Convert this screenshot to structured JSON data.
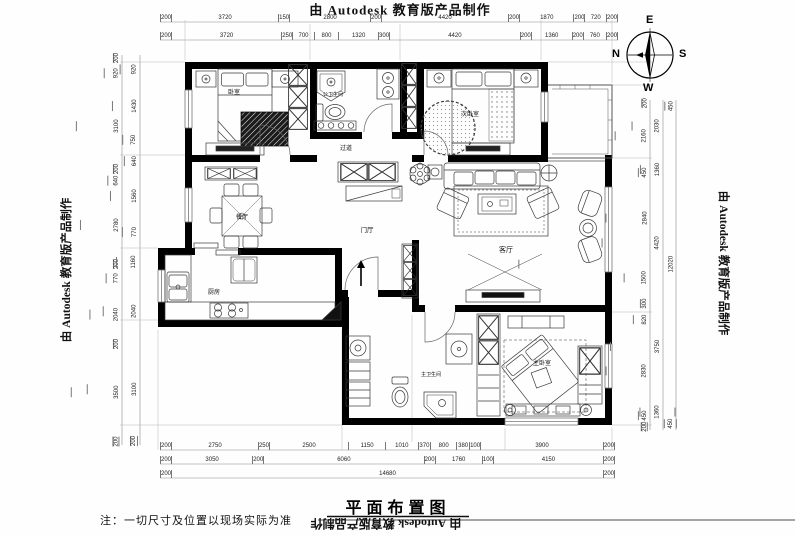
{
  "watermark": {
    "text": "由 Autodesk 教育版产品制作"
  },
  "title": {
    "text": "平面布置图"
  },
  "note": {
    "text": "注：一切尺寸及位置以现场实际为准"
  },
  "compass": {
    "e": "E",
    "n": "N",
    "s": "S",
    "w": "W"
  },
  "rooms": {
    "bedroom1": {
      "label": "卧室"
    },
    "bath1": {
      "label": "公卫生间"
    },
    "bedroom2": {
      "label": "次卧室"
    },
    "dining": {
      "label": "餐厅"
    },
    "corridor": {
      "label": "过道"
    },
    "foyer": {
      "label": "门厅"
    },
    "living": {
      "label": "客厅"
    },
    "kitchen": {
      "label": "厨房"
    },
    "bath2": {
      "label": "主卫生间"
    },
    "master": {
      "label": "主卧室"
    }
  },
  "dimensions": {
    "top_row1": [
      "200",
      "3720",
      "150",
      "2800",
      "200",
      "4420",
      "200",
      "1870",
      "200",
      "720",
      "200"
    ],
    "top_row2": [
      "200",
      "3720",
      "250",
      "700",
      "800",
      "1320",
      "300",
      "4420",
      "200",
      "1360",
      "200",
      "760",
      "200"
    ],
    "bottom_row1": [
      "200",
      "2750",
      "250",
      "2500",
      "1150",
      "1010",
      "370",
      "800",
      "380",
      "100",
      "3900",
      "200"
    ],
    "bottom_row2": [
      "200",
      "3050",
      "200",
      "6060",
      "200",
      "1760",
      "100",
      "4150",
      "200"
    ],
    "bottom_row3": [
      "200",
      "14680",
      "200"
    ],
    "left_col1": [
      "200",
      "920",
      "3100",
      "200",
      "640",
      "2780",
      "200",
      "770",
      "2040",
      "200",
      "3500",
      "200"
    ],
    "left_col2": [
      "920",
      "1430",
      "750",
      "640",
      "1560",
      "770",
      "1160",
      "2040",
      "3100",
      "200"
    ],
    "right_col1": [
      "200",
      "2160",
      "450",
      "2840",
      "1500",
      "300",
      "820",
      "2830",
      "450",
      "200"
    ],
    "right_col2": [
      "2030",
      "1360",
      "4420",
      "3750",
      "1360"
    ],
    "right_col3": [
      "450",
      "12020",
      "450"
    ]
  }
}
